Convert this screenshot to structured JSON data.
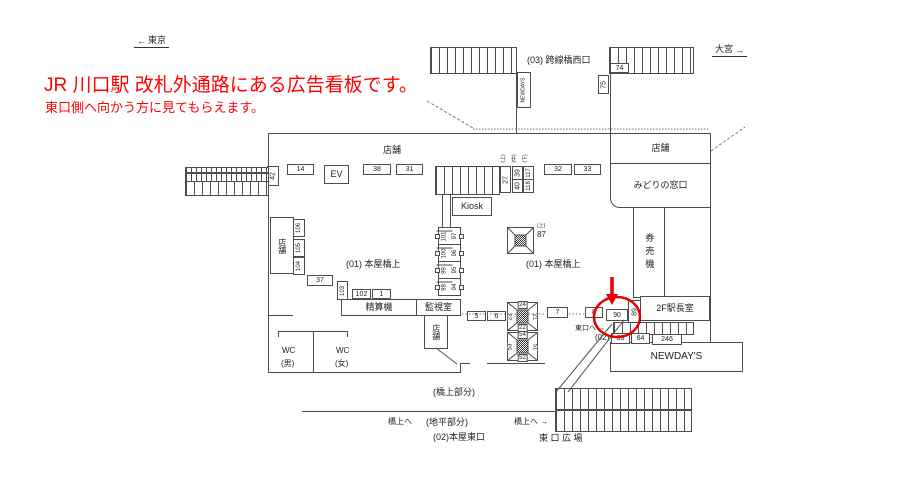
{
  "colors": {
    "red_text": "#ff0000",
    "highlight": "#e60000",
    "line": "#4d4d4d"
  },
  "note": {
    "line1": "JR 川口駅 改札外通路にある広告看板です。",
    "line2": "東口側へ向かう方に見てもらえます。"
  },
  "compass": {
    "left_arrow": "←",
    "left_label": "東京",
    "right_label": "大宮",
    "right_arrow": "→"
  },
  "overpass": {
    "label": "(03) 跨線橋西口",
    "newdays_kiosk": "NEWDAYS",
    "ad_74": "74",
    "ad_75": "75"
  },
  "rooms": {
    "shop_top": "店舗",
    "shop_right": "店舗",
    "midori_window": "みどりの窓口",
    "ticket_machines": "券売機",
    "stationmaster_2f": "2F駅長室",
    "newdays_store": "NEWDAY'S",
    "kiosk": "Kiosk",
    "shop_left": "店舗",
    "shop_center": "店舗",
    "fare_adjustment": "精算機",
    "monitoring_room": "監視室",
    "wc": "WC",
    "wc_men": "(男)",
    "wc_women": "(女)"
  },
  "zones": {
    "honya_bridge_left": "(01) 本屋橋上",
    "honya_bridge_right": "(01) 本屋橋上",
    "bridge_part": "(橋上部分)",
    "ground_part": "(地平部分)",
    "honya_east_exit": "(02)本屋東口",
    "zone02": "(02)",
    "to_bridge_left": "橋上へ",
    "to_bridge_right": "橋上へ →",
    "to_east_exit": "東口へ →",
    "east_plaza": "東 口 広 場"
  },
  "ads": {
    "a14": "14",
    "ev": "EV",
    "a38": "38",
    "a31": "31",
    "a27": "27",
    "a39": "39",
    "a40": "40",
    "a117": "117",
    "a118": "118",
    "a32": "32",
    "a33": "33",
    "a42": "42",
    "a106": "106",
    "a105": "105",
    "a104": "104",
    "a37": "37",
    "a103": "103",
    "a102": "102",
    "a1": "1",
    "a101": "101",
    "a97": "97",
    "a100": "100",
    "a96": "96",
    "a99": "99",
    "a95": "95",
    "a98": "98",
    "a94": "94",
    "a87": "87",
    "a87_pos": "(上)",
    "a5": "5",
    "a6": "6",
    "a7": "7",
    "a8": "8",
    "a90": "90",
    "a89": "89",
    "a63": "63",
    "a64": "64",
    "a246": "246",
    "pos_upper": "(上)",
    "pos_middle": "(中)",
    "pos_lower": "(下)"
  },
  "pillar_24": {
    "top": "24",
    "right": "21",
    "bottom": "22",
    "left": "23"
  },
  "pillar_54": {
    "top": "54",
    "right": "51",
    "bottom": "52",
    "left": "53"
  }
}
